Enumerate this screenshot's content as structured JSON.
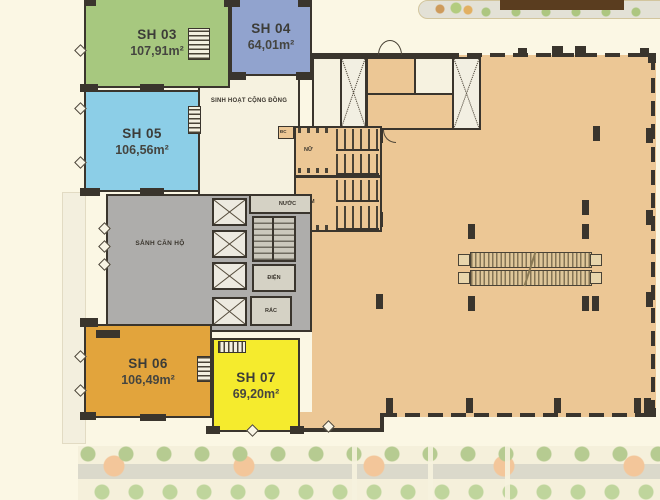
{
  "plan": {
    "units": [
      {
        "id": "sh03",
        "name": "SH 03",
        "area": "107,91m²",
        "color": "#A7C87F"
      },
      {
        "id": "sh04",
        "name": "SH 04",
        "area": "64,01m²",
        "color": "#91A3CE"
      },
      {
        "id": "sh05",
        "name": "SH 05",
        "area": "106,56m²",
        "color": "#8CCEE7"
      },
      {
        "id": "sh06",
        "name": "SH 06",
        "area": "106,49m²",
        "color": "#E2A43C"
      },
      {
        "id": "sh07",
        "name": "SH 07",
        "area": "69,20m²",
        "color": "#F5EB2D"
      }
    ],
    "rooms": {
      "community": "SINH HOẠT CỘNG ĐỒNG",
      "lobby": "SẢNH CĂN HỘ",
      "water": "NƯỚC",
      "electrical": "ĐIỆN",
      "trash": "RÁC",
      "wc_female": "NỮ",
      "wc_male": "NAM",
      "duct": "ĐC"
    },
    "colors": {
      "background": "#FBF7E4",
      "wall": "#3A352D",
      "retail": "#ECC795",
      "lobby_gray": "#AEADAB",
      "community": "#F6F2E0",
      "canopy": "#5A3D1F",
      "landscape_green": "#8FBA62",
      "landscape_path": "#EE9F5F"
    }
  }
}
